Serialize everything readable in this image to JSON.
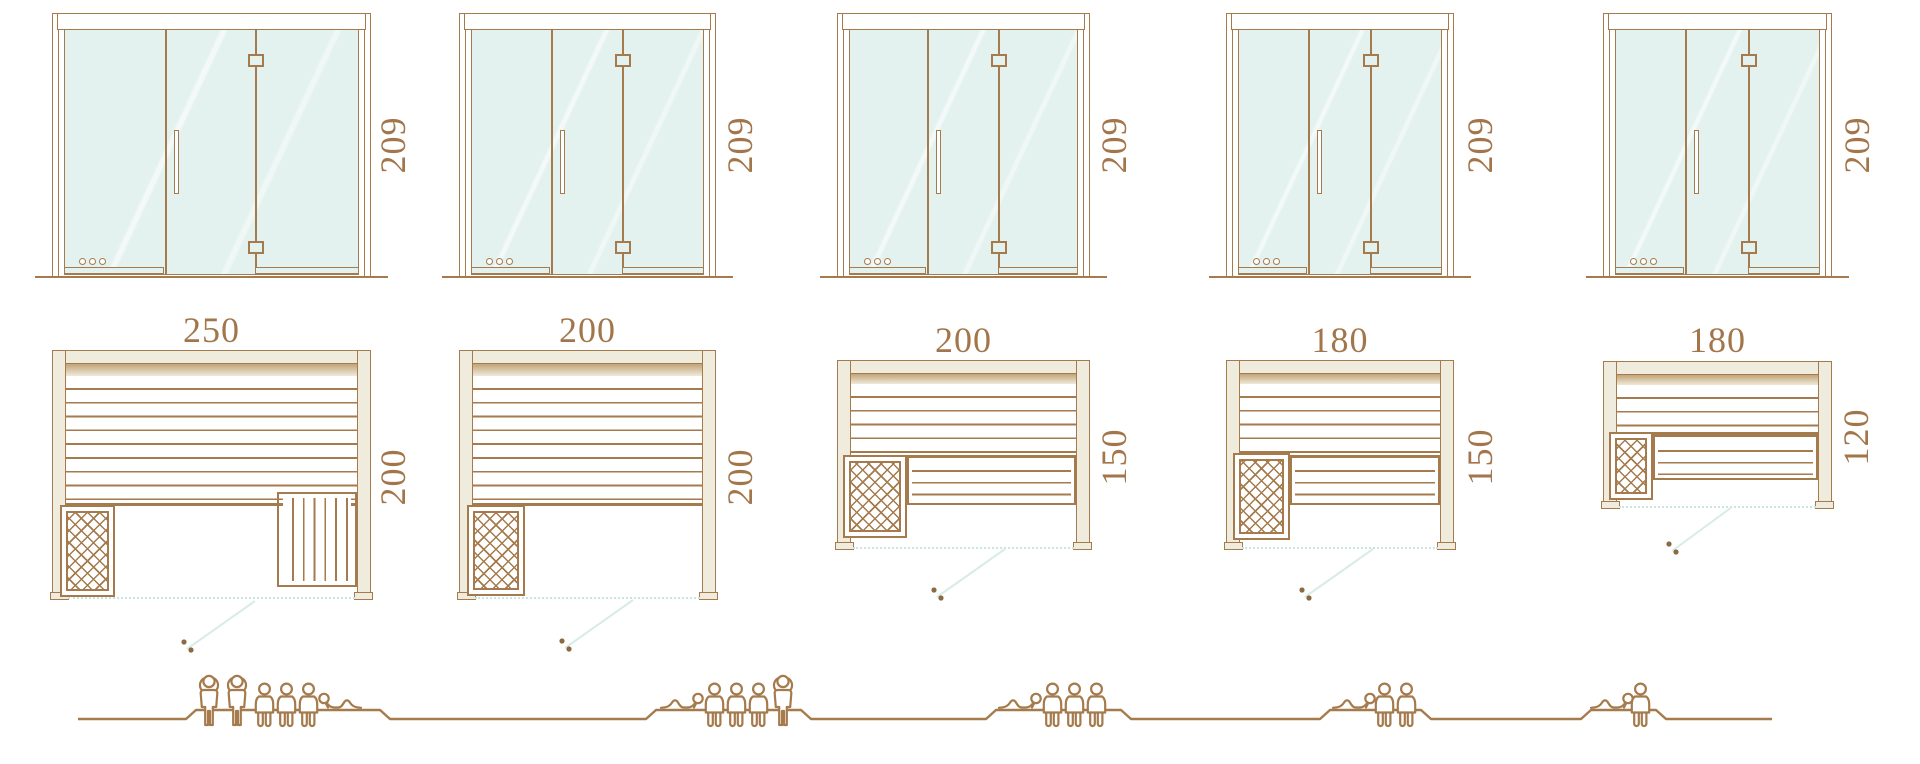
{
  "diagram": {
    "title": "sauna-size-comparison",
    "description": "Five sauna sizes: glass door front elevation, floor plan with heater and benches, and seating capacity silhouettes",
    "colors": {
      "line": "#a57a4c",
      "text": "#a2764a",
      "glass": "#e4f2ef",
      "wall_fill": "#efecdd",
      "glass_front_line": "#c9e5df",
      "door_swing_line": "#d8ece7"
    }
  },
  "units": [
    {
      "door_height": "209",
      "width": "250",
      "depth": "200",
      "capacity": {
        "standing": 2,
        "seated": 3,
        "lying": 1,
        "total": 6
      }
    },
    {
      "door_height": "209",
      "width": "200",
      "depth": "200",
      "capacity": {
        "standing": 1,
        "seated": 3,
        "lying": 1,
        "total": 5
      }
    },
    {
      "door_height": "209",
      "width": "200",
      "depth": "150",
      "capacity": {
        "standing": 0,
        "seated": 3,
        "lying": 1,
        "total": 4
      }
    },
    {
      "door_height": "209",
      "width": "180",
      "depth": "150",
      "capacity": {
        "standing": 0,
        "seated": 2,
        "lying": 1,
        "total": 3
      }
    },
    {
      "door_height": "209",
      "width": "180",
      "depth": "120",
      "capacity": {
        "standing": 0,
        "seated": 1,
        "lying": 1,
        "total": 2
      }
    }
  ]
}
